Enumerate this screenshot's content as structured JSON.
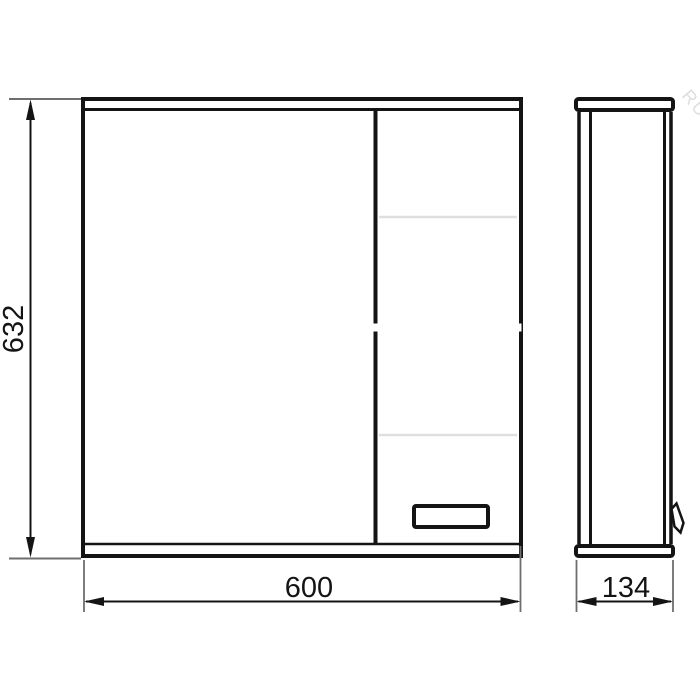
{
  "drawing": {
    "dimensions": {
      "height": "632",
      "width": "600",
      "depth": "134"
    },
    "watermark": "RU",
    "colors": {
      "line": "#141414",
      "extension_line": "#6f6f6f",
      "shelf_line": "#dfdfdf",
      "background": "#ffffff",
      "watermark": "#d9d9d9"
    }
  }
}
